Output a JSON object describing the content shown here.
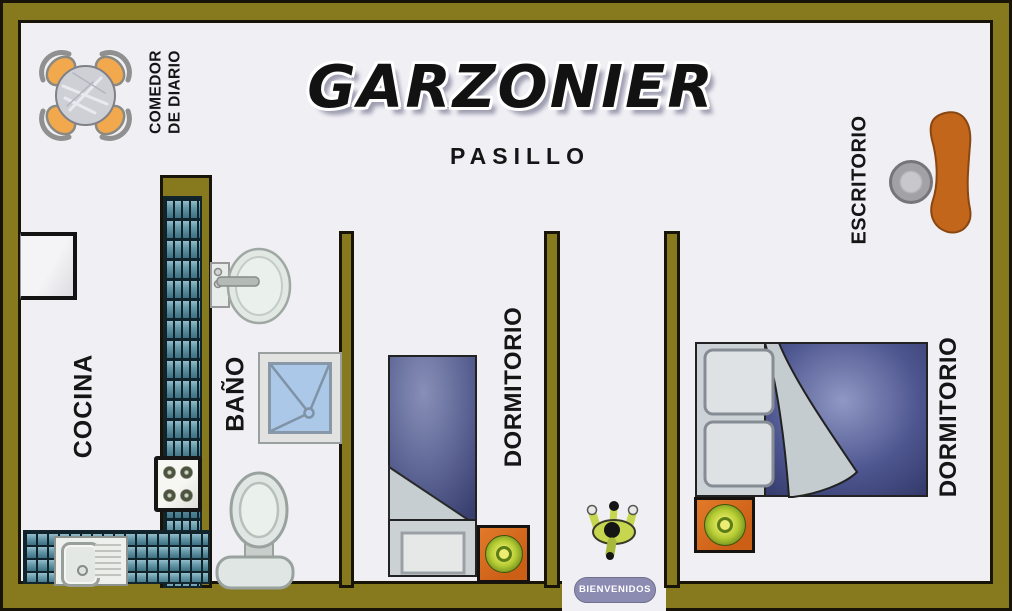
{
  "plan": {
    "title": "GARZONIER",
    "hallway_label": "PASILLO",
    "rooms": [
      {
        "id": "comedor",
        "label": "COMEDOR\nDE DIARIO"
      },
      {
        "id": "cocina",
        "label": "COCINA"
      },
      {
        "id": "bano",
        "label": "BAÑO"
      },
      {
        "id": "dormitorio1",
        "label": "DORMITORIO"
      },
      {
        "id": "dormitorio2",
        "label": "DORMITORIO"
      },
      {
        "id": "escritorio",
        "label": "ESCRITORIO"
      }
    ],
    "entrance": {
      "mat_label": "BIENVENIDOS"
    },
    "colors": {
      "wall_olive": "#877a1e",
      "floor": "#f0eff4",
      "outline_black": "#181408",
      "tile_teal": "#679aaa",
      "blanket_blue": "#4e5690",
      "sheet_grey": "#c6ced2",
      "nightstand_orange": "#cc5f16",
      "desk_orange": "#c2661c",
      "lamp_green": "#b5cb33",
      "dining_chair_orange": "#f2a94e",
      "shower_blue": "#abc8e8",
      "fixture_grey": "#e0e6e4",
      "mat_lavender": "#8c8cb2",
      "person_green": "#c6d64e"
    }
  }
}
